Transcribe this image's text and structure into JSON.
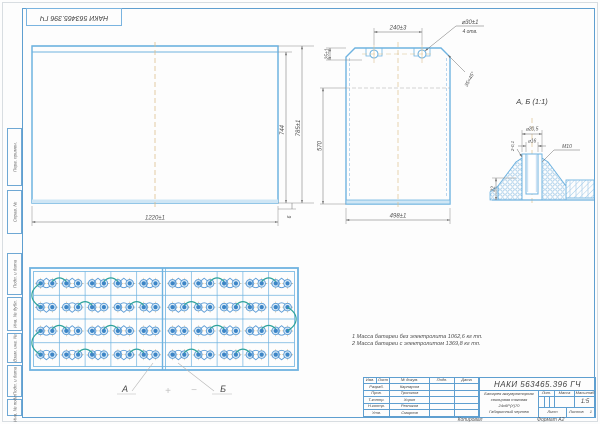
{
  "sheet": {
    "stamp_rotated": "НАКИ 563465.396 ГЧ",
    "copied_label": "Копировал",
    "format_label": "Формат  А2"
  },
  "margin_labels": [
    "Перв. примен.",
    "Справ. №",
    "Подп. и дата",
    "Инв. № дубл.",
    "Взам. инв. №",
    "Подп. и дата",
    "Инв. № подл."
  ],
  "front_view": {
    "dim_width": "1220±1",
    "dim_inner_height": "744",
    "dim_height": "785±1",
    "dim_bottom": "6"
  },
  "side_view": {
    "dim_hole_spacing": "240±3",
    "hole_callout_line1": "⌀30±1",
    "hole_callout_line2": "4 отв.",
    "dim_top": "25±1",
    "dim_inner": "570",
    "dim_chamfer": "35×45°",
    "dim_width": "498±1"
  },
  "detail_view": {
    "title": "А, Б (1:1)",
    "dim_d_outer": "⌀20,5",
    "dim_d_inner": "⌀16",
    "dim_thread": "M10",
    "dim_height": "22",
    "dim_depth": "2-0,1"
  },
  "top_view": {
    "rows": 4,
    "cols_per_half": 5,
    "label_a": "А",
    "label_b": "Б",
    "plus": "+",
    "minus": "−"
  },
  "notes": {
    "line1": "1 Масса батареи без электролита 1062,6 кг тп.",
    "line2": "2 Масса батареи с электролитом 1369,8 кг тп."
  },
  "title_block": {
    "designation": "НАКИ 563465.396 ГЧ",
    "name_line1": "Батарея аккумуляторная",
    "name_line2": "свинцовая тяговая",
    "name_line3": "24х6Р(У)70",
    "name_line4": "Габаритный чертеж",
    "header": [
      "Изм.",
      "Лист",
      "№ докум.",
      "Подп.",
      "Дата"
    ],
    "sign_rows": [
      [
        "Разраб.",
        "Карнаухов"
      ],
      [
        "Пров.",
        "Тропилов"
      ],
      [
        "Т.контр.",
        "Хорин"
      ],
      [
        "Н.контр.",
        "Резников"
      ],
      [
        "Утв.",
        "Смирнов"
      ]
    ],
    "lit_label": "Лит.",
    "mass_label": "Масса",
    "scale_label": "Масштаб",
    "scale_value": "1:5",
    "sheet_label": "Лист",
    "sheets_label": "Листов",
    "sheets_value": "1"
  },
  "colors": {
    "line_blue": "#6fb3e0",
    "fill_blue": "#3d85c6",
    "centerline_orange": "#dcc08e",
    "connector_teal": "#2fa39b",
    "dim_gray": "#7a7a7a"
  }
}
